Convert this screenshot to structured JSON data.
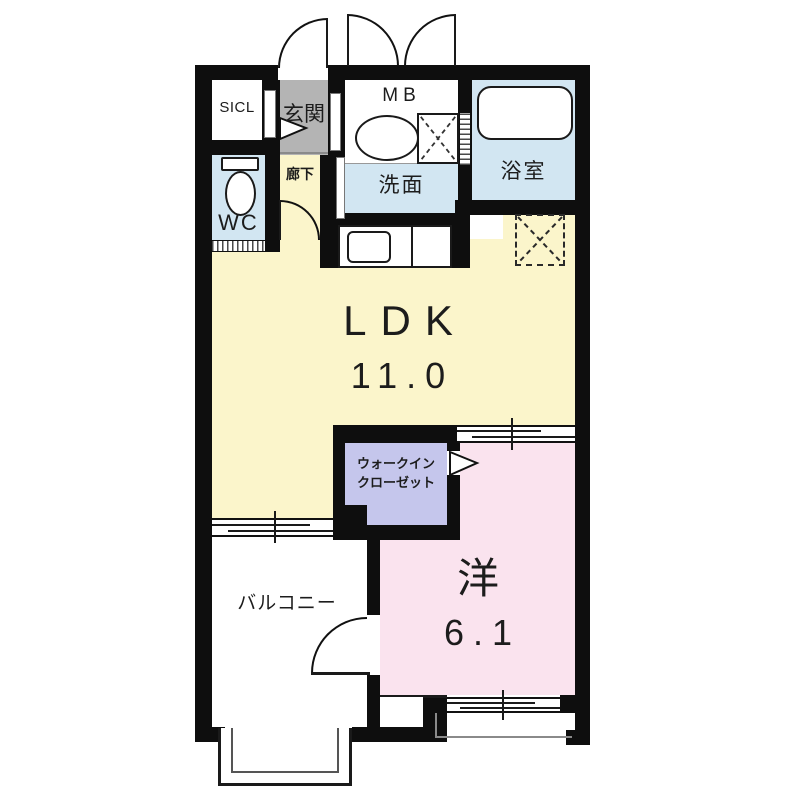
{
  "plan_type": "floor-plan",
  "rooms": {
    "sicl": {
      "label": "SICL"
    },
    "genkan": {
      "label": "玄関"
    },
    "mb": {
      "label": "MB"
    },
    "senmen": {
      "label": "洗面"
    },
    "bathroom": {
      "label": "浴室"
    },
    "wc": {
      "label": "WC"
    },
    "hallway": {
      "label": "廊下"
    },
    "ldk": {
      "label": "LDK",
      "size": "11.0"
    },
    "wic": {
      "label1": "ウォークイン",
      "label2": "クローゼット"
    },
    "western": {
      "label": "洋",
      "size": "6.1"
    },
    "balcony": {
      "label": "バルコニー"
    }
  },
  "colors": {
    "wall": "#0e0e0e",
    "ldk_yellow": "#fbf5cb",
    "water_blue": "#d2e6f2",
    "genkan_gray": "#b4b4b4",
    "closet_purple": "#c5c6ec",
    "western_pink": "#fae3ee"
  }
}
